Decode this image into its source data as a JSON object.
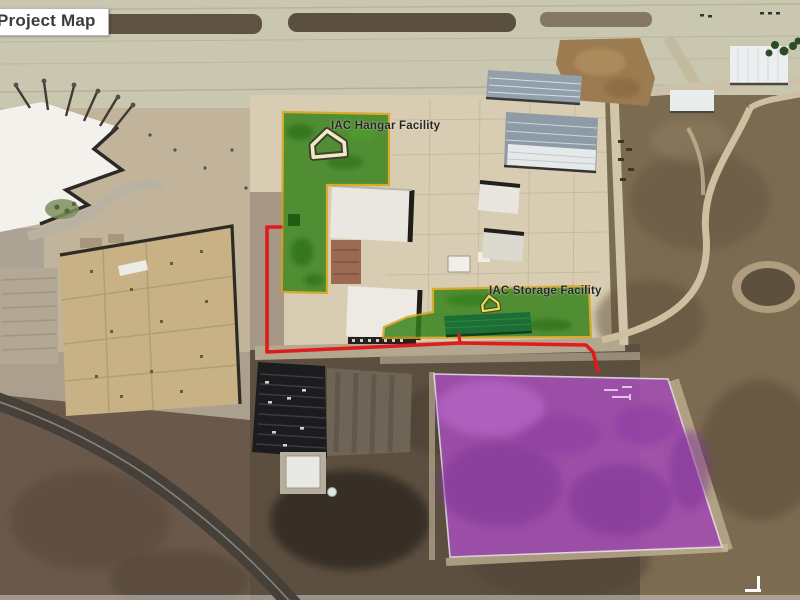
{
  "title": {
    "label": "Project Map"
  },
  "map": {
    "areas": [
      {
        "id": "iac-hangar-facility",
        "label": "IAC Hangar Facility",
        "fill": "#338018",
        "border": "#d8a312",
        "marker": "house-icon"
      },
      {
        "id": "iac-storage-facility",
        "label": "IAC Storage Facility",
        "fill": "#338018",
        "border": "#d8a312",
        "marker": "house-icon"
      },
      {
        "id": "proposed-site",
        "label": "",
        "fill": "#a54fb5",
        "border": "#e8dcee",
        "marker": ""
      }
    ],
    "boundary_line_color": "#e01b1b",
    "marker_icon": "house-icon"
  }
}
